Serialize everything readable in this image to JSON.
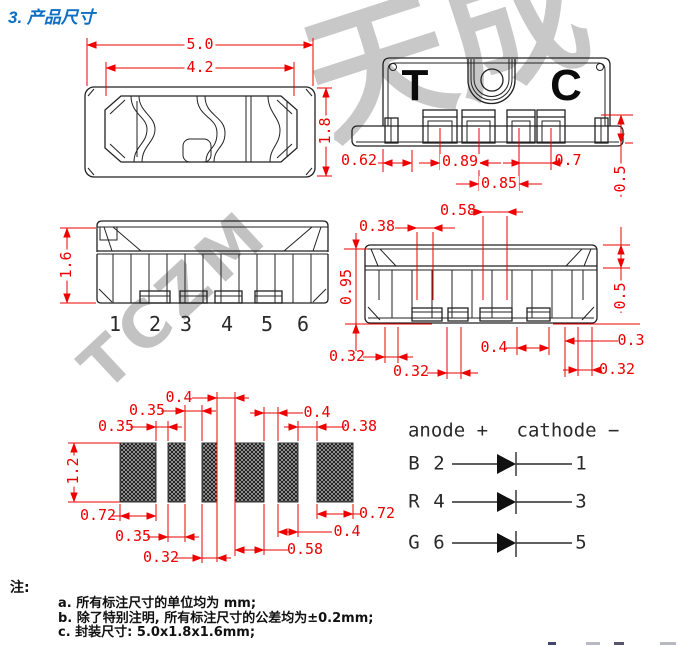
{
  "title": "3. 产品尺寸",
  "watermark": {
    "diagonal": "TCZM",
    "corner": "天成"
  },
  "views": {
    "top": {
      "dim_outer_width": "5.0",
      "dim_opening_width": "4.2",
      "dim_depth": "1.8"
    },
    "bottom": {
      "mark_left": "T",
      "mark_right": "C",
      "dim_edge_to_pin1": "0.62",
      "dim_pitch_12": "0.89",
      "dim_pitch_23": "0.85",
      "dim_pitch_34": "0.7",
      "dim_lead_length": "0.5"
    },
    "front": {
      "dim_height": "1.6",
      "pins": [
        "1",
        "2",
        "3",
        "4",
        "5",
        "6"
      ]
    },
    "back": {
      "dim_038": "0.38",
      "dim_058": "0.58",
      "dim_095": "0.95",
      "dim_05": "0.5",
      "dim_04": "0.4",
      "dim_03": "0.3",
      "dim_032_left": "0.32",
      "dim_032_mid": "0.32",
      "dim_032_right": "0.32"
    }
  },
  "pad_layout": {
    "dim_height": "1.2",
    "dim_gap12": "0.35",
    "dim_gap23": "0.35",
    "dim_gap34": "0.4",
    "dim_gap45": "0.4",
    "dim_gap56": "0.38",
    "dim_pad1": "0.72",
    "dim_pad2": "0.35",
    "dim_pad3": "0.32",
    "dim_pad4": "0.58",
    "dim_pad5": "0.4",
    "dim_pad6": "0.72"
  },
  "circuit": {
    "anode_header": "anode +",
    "cathode_header": "cathode −",
    "rows": [
      {
        "channel": "B",
        "anode_pin": "2",
        "cathode_pin": "1"
      },
      {
        "channel": "R",
        "anode_pin": "4",
        "cathode_pin": "3"
      },
      {
        "channel": "G",
        "anode_pin": "6",
        "cathode_pin": "5"
      }
    ]
  },
  "notes": {
    "label": "注:",
    "items": [
      "a. 所有标注尺寸的单位均为 mm;",
      "b. 除了特别注明, 所有标注尺寸的公差均为±0.2mm;",
      "c. 封装尺寸: 5.0x1.8x1.6mm;"
    ]
  },
  "colors": {
    "dimension_red": "#ee0000",
    "title_blue": "#0d6ec4",
    "drawing_line": "#222222",
    "watermark_gray": "#b3b3b3"
  }
}
